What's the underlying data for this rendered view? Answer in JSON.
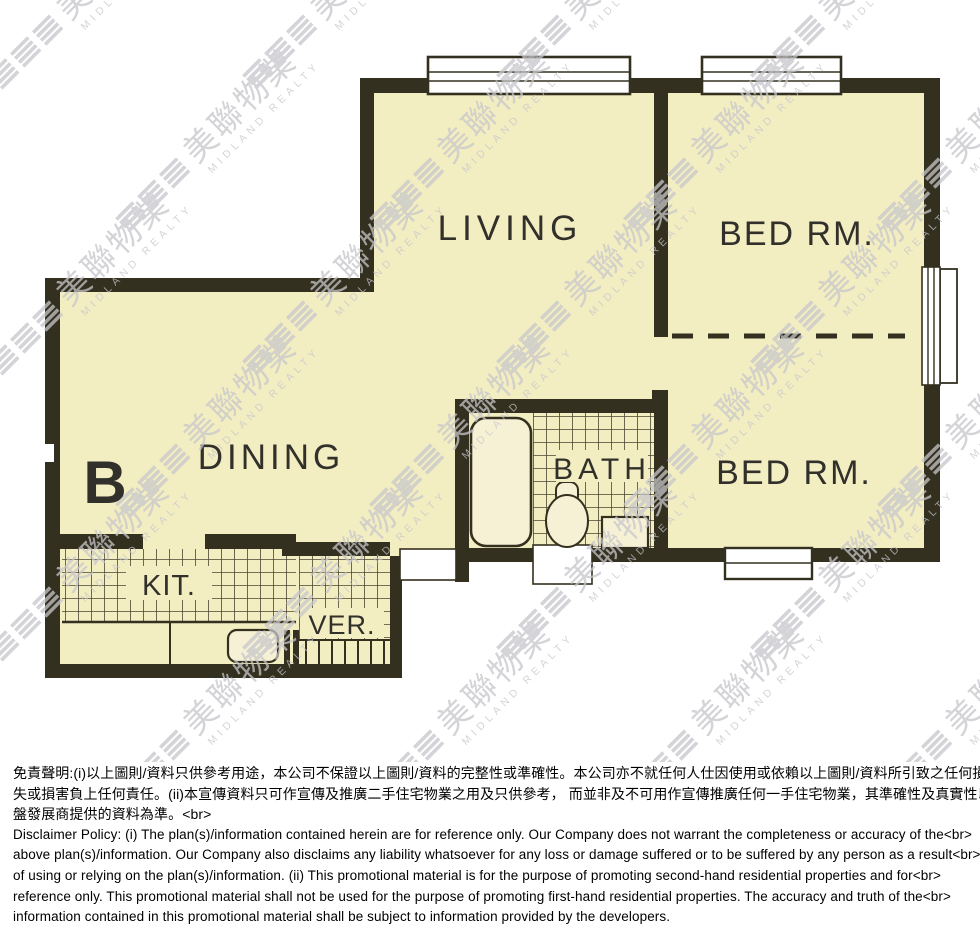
{
  "watermark": {
    "brand_zh": "美聯物業",
    "brand_en": "MIDLAND REALTY"
  },
  "floorplan": {
    "unit_label": "B",
    "rooms": [
      {
        "id": "living",
        "label": "LIVING"
      },
      {
        "id": "bed-rm-top",
        "label": "BED RM."
      },
      {
        "id": "bed-rm-bottom",
        "label": "BED RM."
      },
      {
        "id": "dining",
        "label": "DINING"
      },
      {
        "id": "bath",
        "label": "BATH"
      },
      {
        "id": "kitchen",
        "label": "KIT."
      },
      {
        "id": "verandah",
        "label": "VER."
      }
    ]
  },
  "disclaimer": {
    "lines": [
      "免責聲明:(i)以上圖則/資料只供參考用途，本公司不保證以上圖則/資料的完整性或準確性。本公司亦不就任何人仕因使用或依賴以上圖則/資料所引致之任何損<br>",
      "失或損害負上任何責任。(ii)本宣傳資料只可作宣傳及推廣二手住宅物業之用及只供參考， 而並非及不可用作宣傳推廣任何一手住宅物業，其準確性及真實性以樓<br>",
      "盤發展商提供的資料為準。<br>",
      "Disclaimer Policy: (i) The plan(s)/information contained herein are for reference only. Our Company does not warrant the completeness or accuracy of the<br>",
      "above plan(s)/information. Our Company also disclaims any liability whatsoever for any loss or damage suffered or to be suffered by any person as a result<br>",
      "of using or relying on the plan(s)/information. (ii) This promotional material is for the purpose of promoting second-hand residential properties and for<br>",
      "reference only. This promotional material shall not be used for the purpose of promoting first-hand residential properties. The accuracy and truth of the<br>",
      "information contained in this promotional material shall be subject to information provided by the developers."
    ]
  },
  "colors": {
    "floor": "#f3edc2",
    "wall": "#34301f",
    "watermark": "#c6c6cb"
  }
}
